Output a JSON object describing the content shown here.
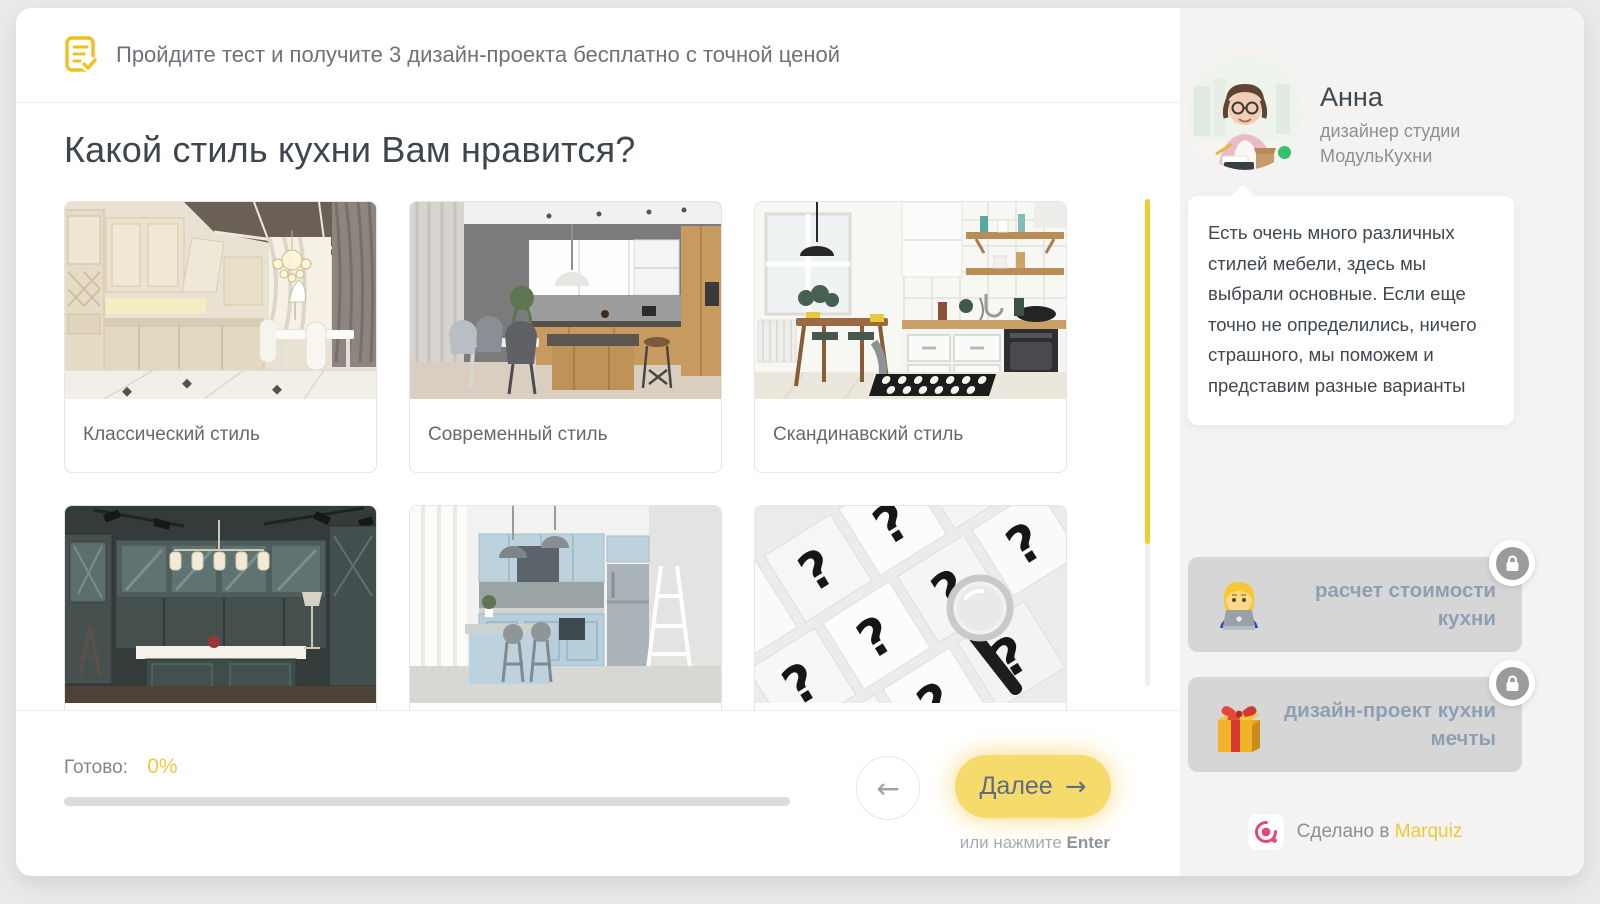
{
  "header": {
    "banner": "Пройдите тест и получите 3 дизайн-проекта бесплатно с точной ценой"
  },
  "question": {
    "title": "Какой стиль кухни Вам нравится?",
    "options": [
      {
        "label": "Классический стиль",
        "image": "classic-kitchen"
      },
      {
        "label": "Современный стиль",
        "image": "modern-kitchen"
      },
      {
        "label": "Скандинавский стиль",
        "image": "scandinavian-kitchen"
      },
      {
        "image": "dark-teal-neoclassic-kitchen"
      },
      {
        "image": "light-blue-kitchen"
      },
      {
        "image": "question-marks-magnifier"
      }
    ]
  },
  "footer": {
    "progress_label": "Готово:",
    "progress_value": "0%",
    "next_label": "Далее",
    "enter_hint": "или нажмите",
    "enter_key": "Enter"
  },
  "sidebar": {
    "designer": {
      "name": "Анна",
      "role": "дизайнер студии МодульКухни"
    },
    "message": "Есть очень много различных стилей мебели, здесь мы выбрали основные. Если еще точно не определились, ничего страшного, мы поможем и представим разные варианты",
    "bonuses": [
      {
        "label": "расчет стоимости кухни",
        "icon": "woman-technologist-emoji",
        "locked": true
      },
      {
        "label": "дизайн-проект кухни мечты",
        "icon": "gift-emoji",
        "locked": true
      }
    ],
    "made_prefix": "Сделано в",
    "made_brand": "Marquiz"
  },
  "colors": {
    "accent_yellow": "#F3CB2E",
    "button_yellow": "#F5DA6C",
    "brand_pink": "#E5477D",
    "online_green": "#35C06A",
    "bonus_label_blue_gray": "#8E9FB4"
  }
}
